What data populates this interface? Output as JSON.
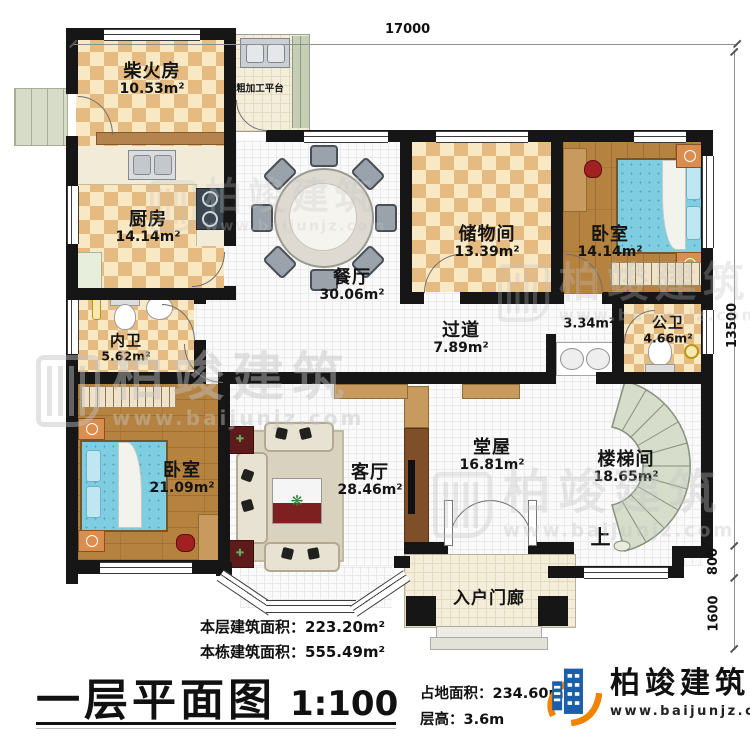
{
  "plan": {
    "rooms": [
      {
        "name": "柴火房",
        "area": "10.53m²"
      },
      {
        "name": "厨房",
        "area": "14.14m²"
      },
      {
        "name": "粗加工平台",
        "area": ""
      },
      {
        "name": "餐厅",
        "area": "30.06m²"
      },
      {
        "name": "储物间",
        "area": "13.39m²"
      },
      {
        "name": "卧室",
        "area": "14.14m²"
      },
      {
        "name": "过道",
        "area": "7.89m²"
      },
      {
        "name": "公卫",
        "area": "4.66m²"
      },
      {
        "name": "内卫",
        "area": "5.62m²"
      },
      {
        "name": "卧室",
        "area": "21.09m²"
      },
      {
        "name": "客厅",
        "area": "28.46m²"
      },
      {
        "name": "堂屋",
        "area": "16.81m²"
      },
      {
        "name": "楼梯间",
        "area": "18.65m²"
      },
      {
        "name": "入户门廊",
        "area": ""
      }
    ],
    "annotations": {
      "closet_area": "3.34m²",
      "stairs_up": "上"
    },
    "dimensions": {
      "top": "17000",
      "right_main": "13500",
      "right_mid": "800",
      "right_bottom": "1600"
    }
  },
  "title_block": {
    "floor_area": "本层建筑面积：223.20m²",
    "building_area": "本栋建筑面积：555.49m²",
    "drawing_title": "一层平面图",
    "scale": "1:100",
    "land_area": "占地面积：234.60m²",
    "floor_height": "层高：3.6m"
  },
  "logo": {
    "company": "柏竣建筑",
    "website": "www.baijunjz.com"
  },
  "watermark": {
    "brand": "柏竣建筑",
    "website": "www.baijunjz.com"
  },
  "colors": {
    "wall": "#161616",
    "checker_dark": "#e5bb82",
    "checker_light": "#f8e8c4",
    "wood": "#b5823f",
    "bed": "#7fcde0",
    "stair": "#d6decb",
    "brand_blue": "#1a5fa8",
    "brand_orange": "#f08300"
  }
}
